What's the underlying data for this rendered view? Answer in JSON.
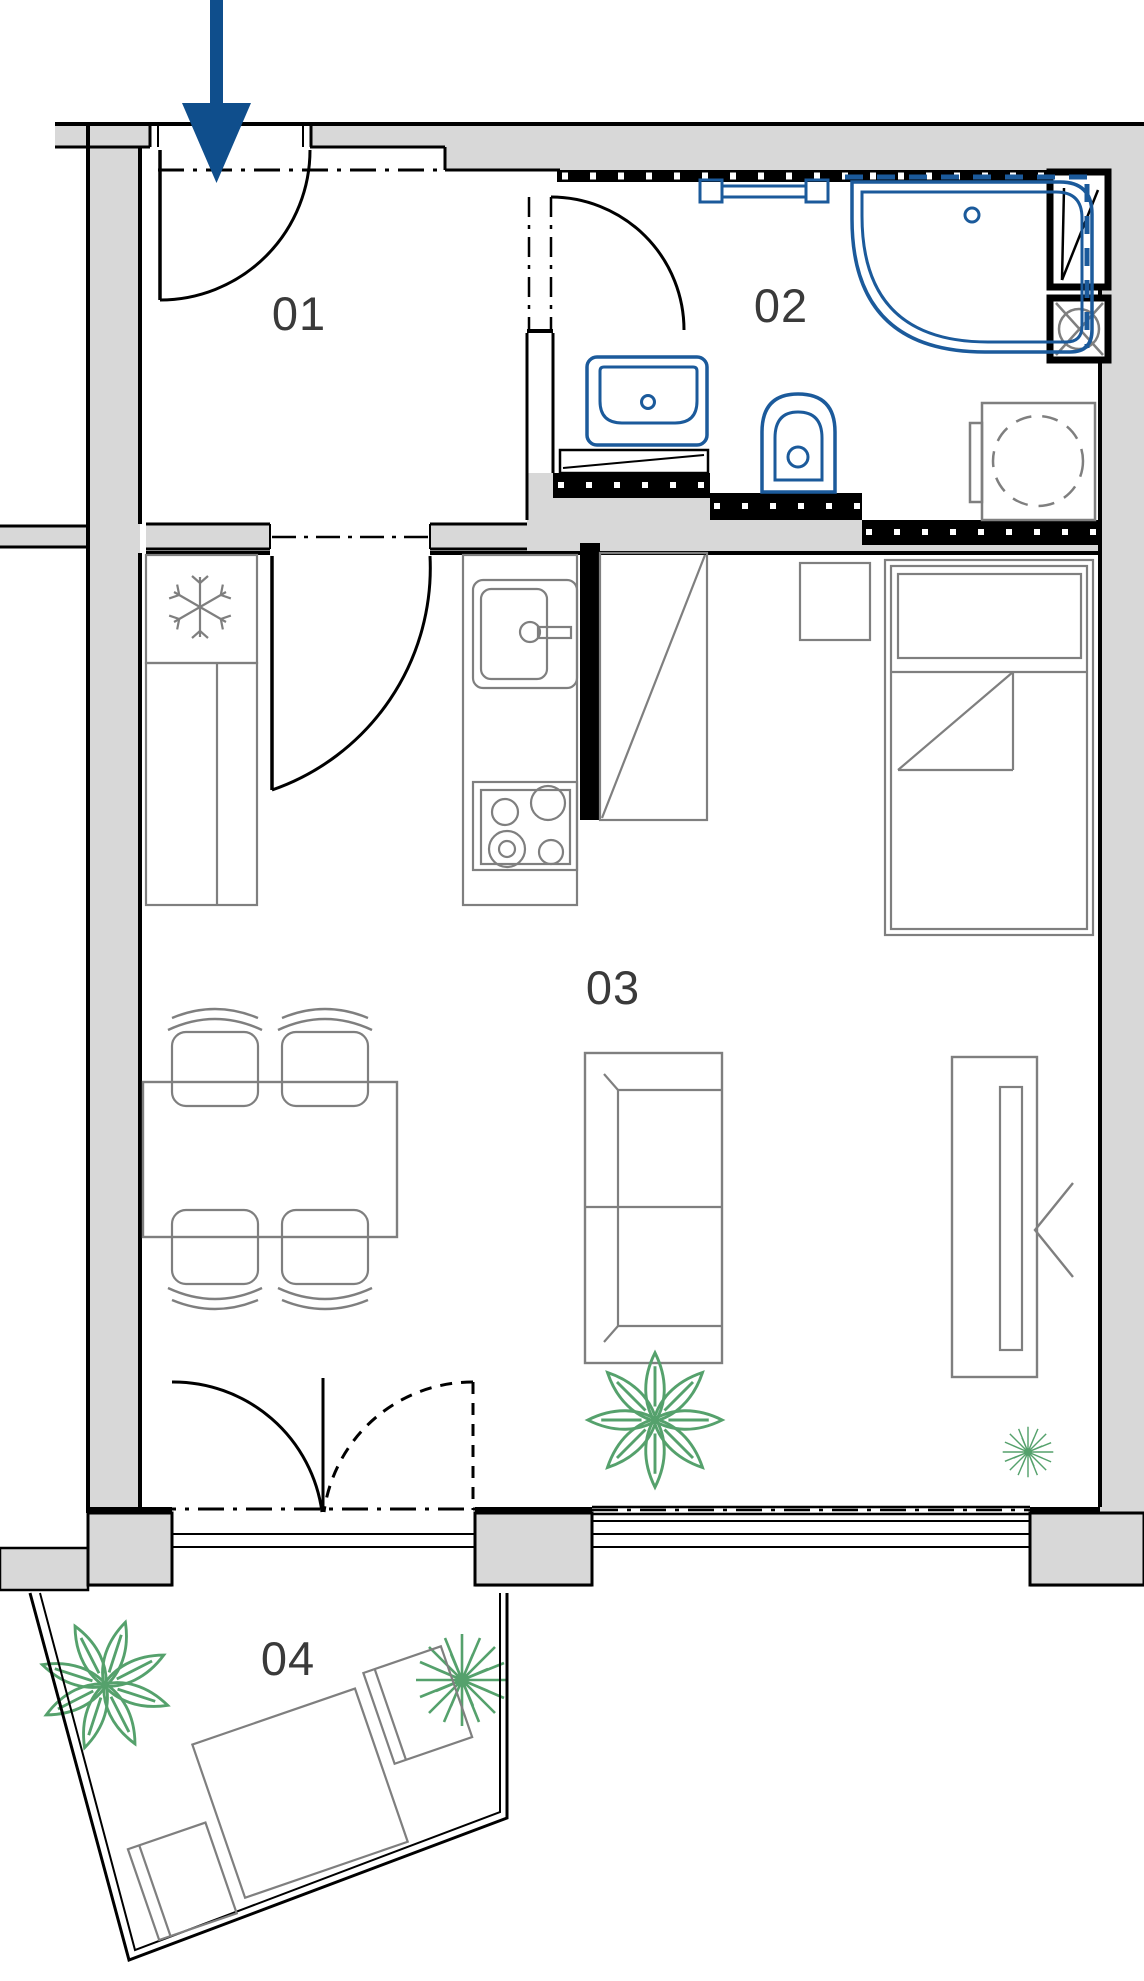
{
  "meta": {
    "title": "Apartment unit floor plan",
    "type": "architectural-floor-plan"
  },
  "rooms": [
    {
      "number": "01",
      "name": "entrance hall"
    },
    {
      "number": "02",
      "name": "bathroom"
    },
    {
      "number": "03",
      "name": "living room with kitchenette and sleeping area"
    },
    {
      "number": "04",
      "name": "balcony"
    }
  ],
  "colors": {
    "background": "#ffffff",
    "wall_fill": "#d8d8d8",
    "wall_line": "#000000",
    "furniture_line": "#7f7f7f",
    "sanitary_line": "#1b5a9b",
    "plant_line": "#55a16c",
    "arrow_fill": "#0f4e8c",
    "label_text": "#3a3a3a"
  },
  "icons": {
    "entrance_arrow": "down-arrow",
    "fridge_symbol": "snowflake-icon",
    "ventilation_symbol": "circle-x-fan-icon",
    "shower_drain": "small-circle",
    "plants": "potted-plant-icon"
  }
}
